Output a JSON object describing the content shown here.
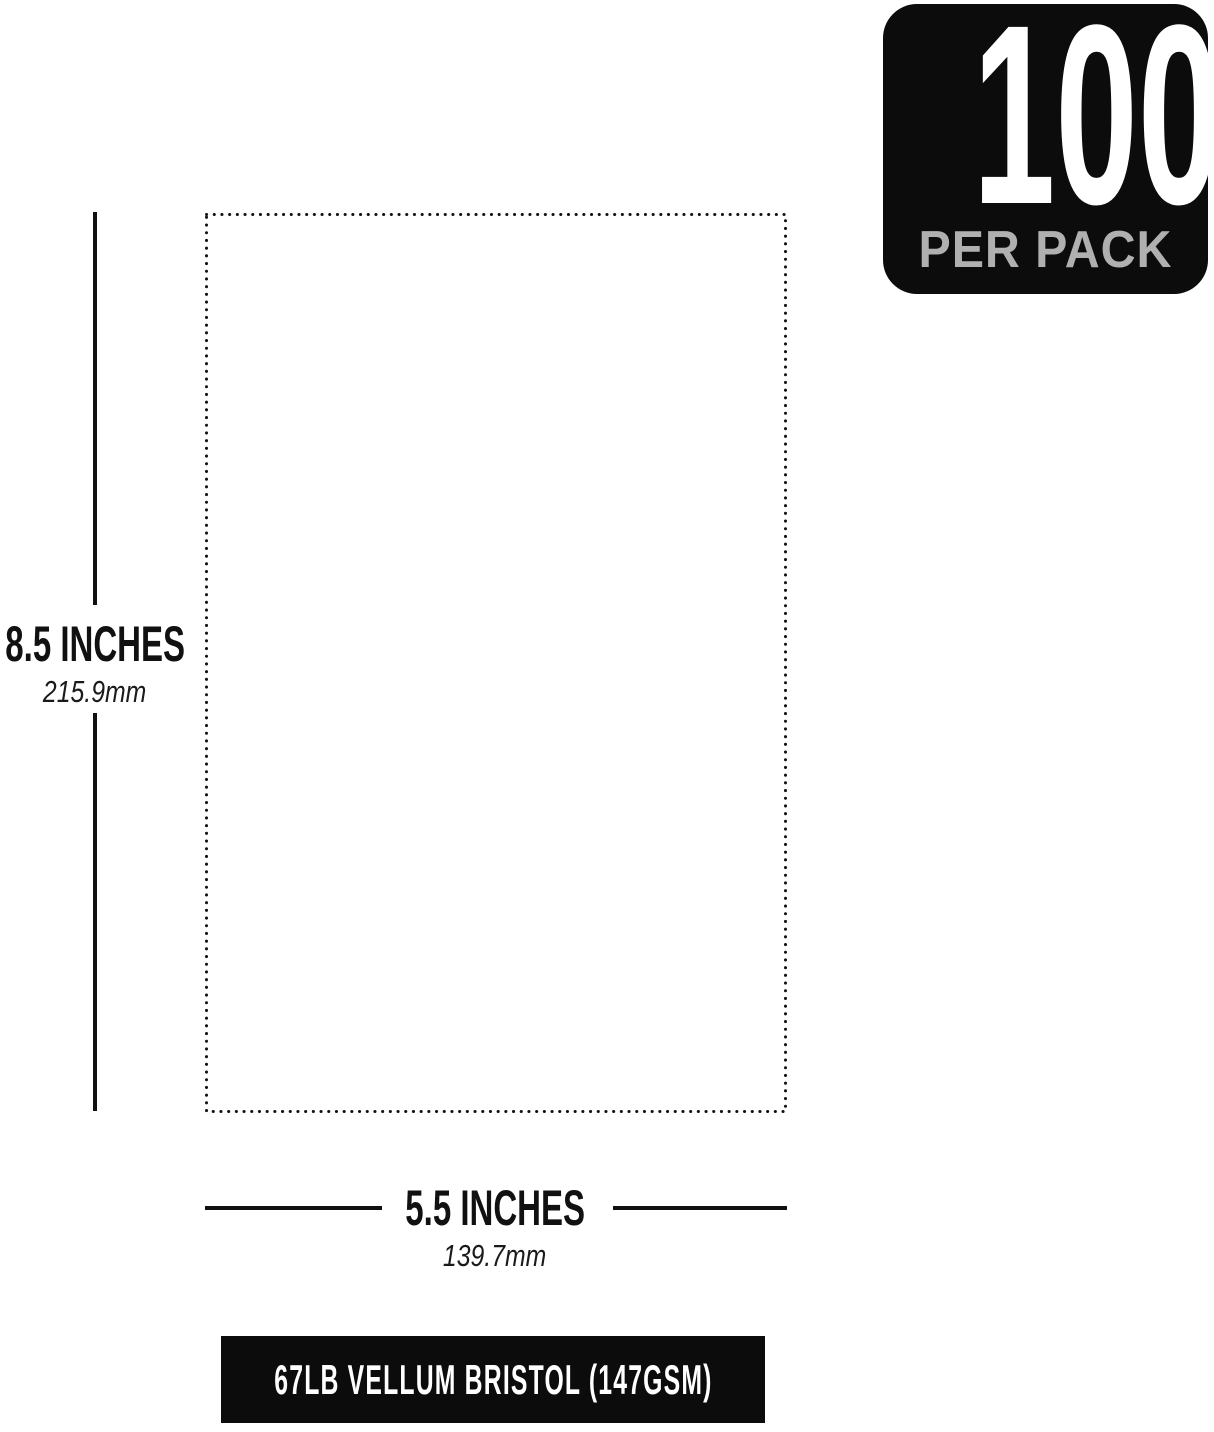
{
  "badge": {
    "count": "100",
    "label": "PER PACK"
  },
  "dimensions": {
    "height": {
      "inches": "8.5 INCHES",
      "metric": "215.9mm"
    },
    "width": {
      "inches": "5.5 INCHES",
      "metric": "139.7mm"
    }
  },
  "footer": {
    "label": "67LB VELLUM BRISTOL (147GSM)"
  },
  "colors": {
    "background": "#ffffff",
    "ink": "#111111",
    "badge_bg": "#0c0c0c",
    "badge_count": "#ffffff",
    "badge_label": "#b0b0b0",
    "footer_bg": "#0c0c0c",
    "footer_text": "#ffffff"
  }
}
